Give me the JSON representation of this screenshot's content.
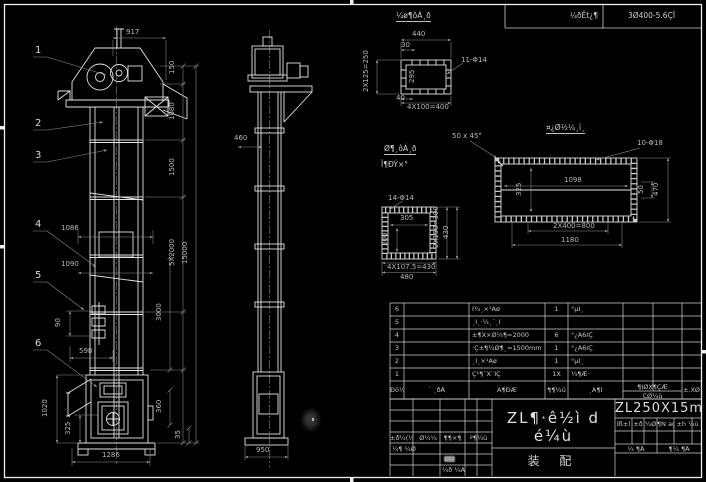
{
  "header": {
    "spec_label": "¼ðÊ­t¿¶",
    "spec_value": "3Ø400-5.6ÇÏ"
  },
  "notes": {
    "detail_a_title": "¼ø¶ôÁ¸ð",
    "detail_b_title_1": "Ø¶¸ôÁ¸ð",
    "detail_b_title_2": "Î¶ÐÝ×°",
    "detail_c_title": "¤¿Ø½¼¸ì¸",
    "chamfer": "50 x 45°"
  },
  "balloons": {
    "b1": "1",
    "b2": "2",
    "b3": "3",
    "b4": "4",
    "b5": "5",
    "b6": "6"
  },
  "front_view": {
    "dims": {
      "width_top": "917",
      "h1": "150",
      "h2": "1080",
      "h3": "1500",
      "h4": "5X2000",
      "total_height": "15000",
      "h5": "3000",
      "h6": "360",
      "h7": "35",
      "w1": "1086",
      "w2": "1090",
      "w3": "90",
      "w4": "598",
      "w5": "1020",
      "w6": "325",
      "width_bottom": "1286"
    }
  },
  "side_view": {
    "dims": {
      "w": "460",
      "base": "950"
    }
  },
  "detail_a": {
    "dims": {
      "d440": "440",
      "d30": "30",
      "left": "2X125=250",
      "inner": "295",
      "d40": "40",
      "bottom": "4X100=400",
      "holes": "11-Φ14"
    }
  },
  "detail_b": {
    "dims": {
      "holes": "14-Φ14",
      "inner_w": "305",
      "inner_h": "300",
      "right1": "2X150=300",
      "right2": "430",
      "bottom1": "4X107.5=430",
      "bottom2": "480"
    }
  },
  "detail_c": {
    "dims": {
      "holes": "10-Φ18",
      "inner_w": "1098",
      "inner_h": "325",
      "right1": "50",
      "right2": "470",
      "bottom1": "2X400=800",
      "bottom2": "1180"
    }
  },
  "bom": {
    "rows": [
      {
        "no": "6",
        "code": "",
        "name": "Î¼¸×¹Áø",
        "qty": "1",
        "material": "°µÌ¸"
      },
      {
        "no": "5",
        "code": "",
        "name": "¸Î¸·¼¸´¸Î",
        "qty": "",
        "material": ""
      },
      {
        "no": "4",
        "code": "",
        "name": "±¶X×Ø¼¶=2000",
        "qty": "6",
        "material": "°¿Ä6ÍÇ"
      },
      {
        "no": "3",
        "code": "",
        "name": "·Ç±¶¼Ø¶¸=1500mm",
        "qty": "1",
        "material": "°¿Ä6ÍÇ"
      },
      {
        "no": "2",
        "code": "",
        "name": "¸Î¸×¹Áø",
        "qty": "1",
        "material": "°µÌ¸"
      },
      {
        "no": "1",
        "code": "",
        "name": "Ç¹¶¯X¨ÎÇ",
        "qty": "1X",
        "material": "¼¶Æ·"
      }
    ],
    "header": {
      "no": "Ðò¼Ñ",
      "code": "´ ¸ðÅ",
      "name": "Ã¶ÐÆ",
      "qty": "¶¶¼ü",
      "material": "¸Ã¶Ï",
      "weight_top": "¶ÍØX¶ÇÆ",
      "weight_bottom": "ÇØ¼ù",
      "remark": "±,XØ"
    }
  },
  "title_block": {
    "main_title": "ZL¶·ê½ì d é¼ù",
    "sub_title": "装  配",
    "drawing_no": "ZL250X15m",
    "rev": {
      "c1": "±ð¼(¼¶",
      "c2": "¸Ø¼¼",
      "c3": "¶¶×¶",
      "c4": "º¶¼ü",
      "r2": "¼¶ ¼Ø",
      "r3": "¼ð ¼Ä"
    },
    "info": {
      "c1": "Ïß±l",
      "c2": "±ð",
      "c3": "¼Ø",
      "c4": "¶Ñ ag",
      "c5": "±h ¼ù",
      "sheet1": "¼ ¶Å",
      "sheet2": "¶¼ ¶Å"
    }
  }
}
